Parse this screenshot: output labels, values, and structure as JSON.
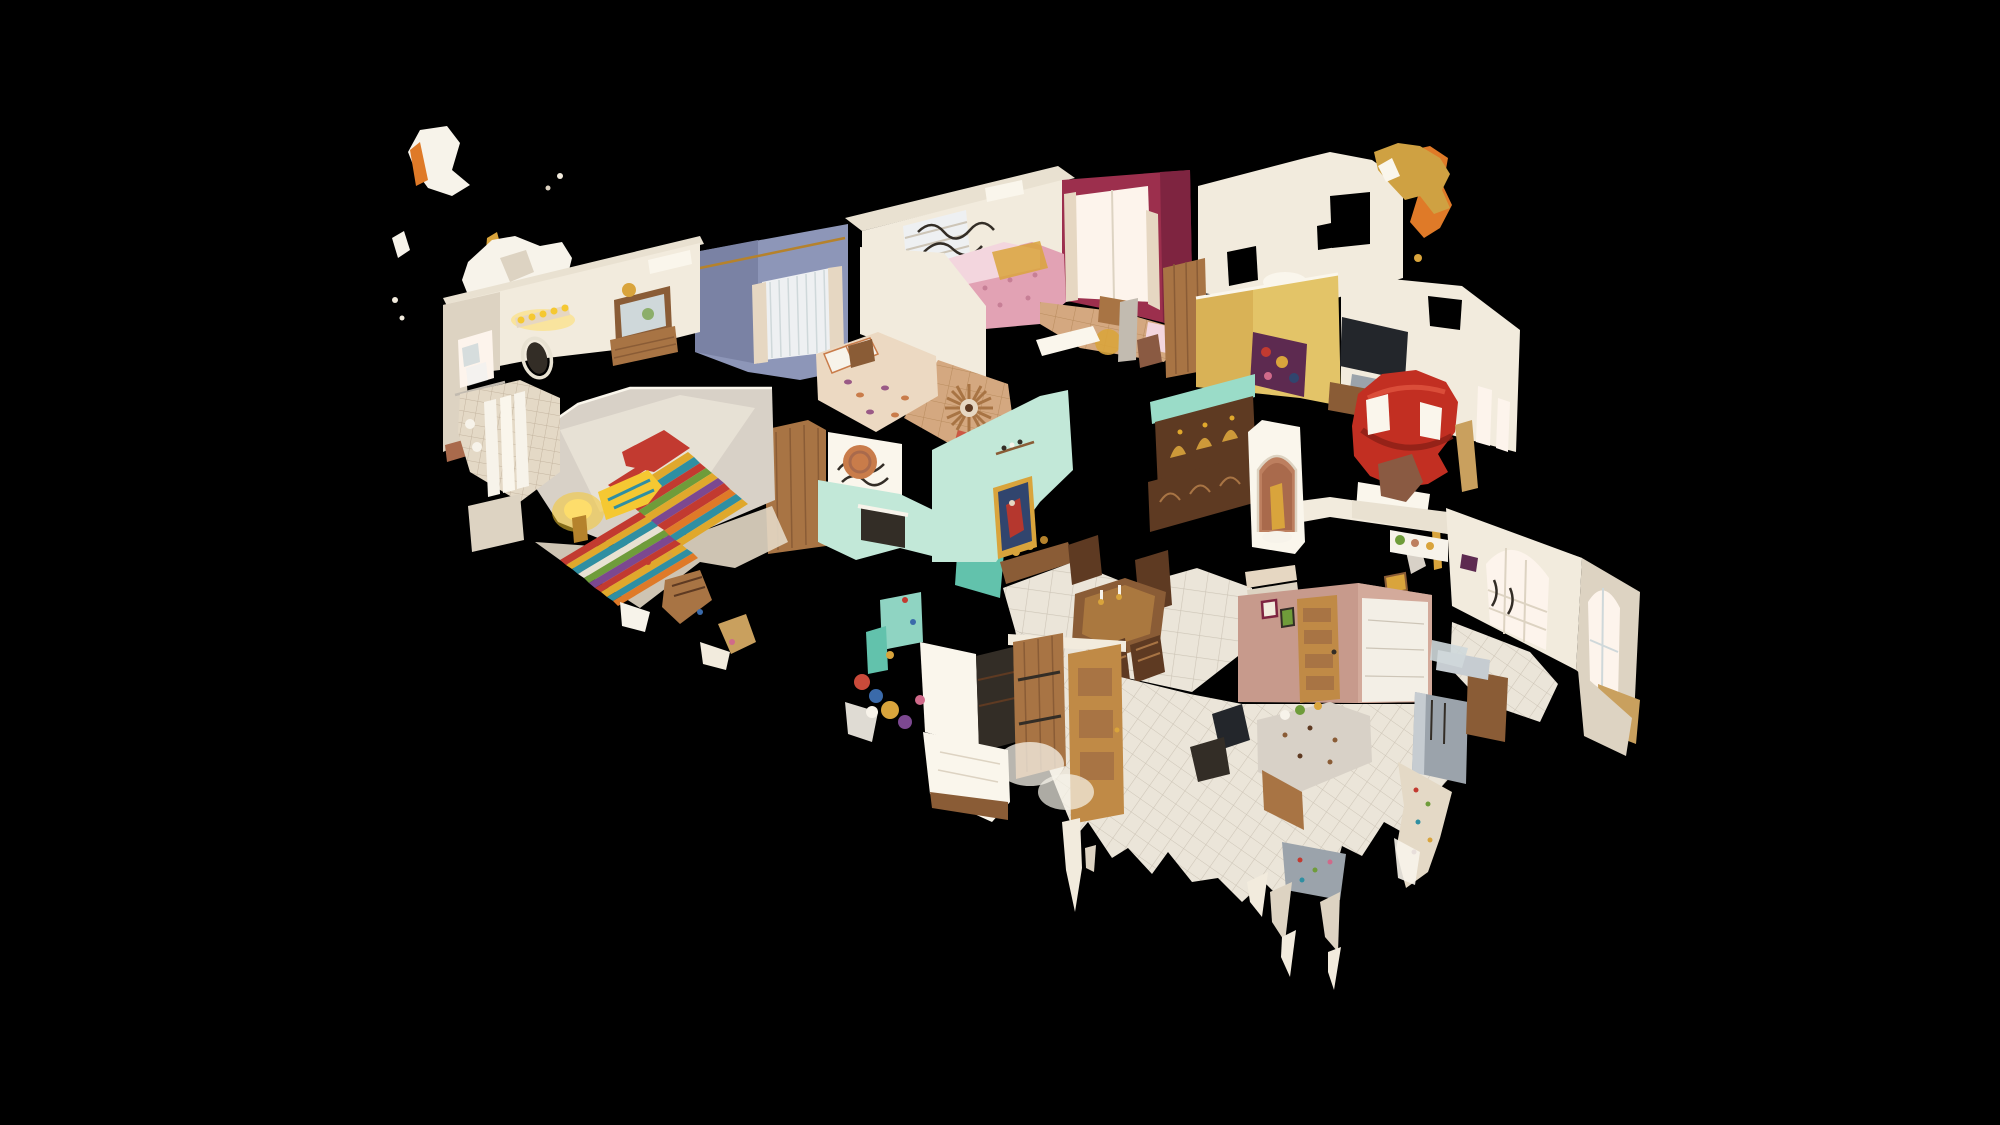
{
  "app": {
    "name": "3D dollhouse viewer",
    "view_mode": "dollhouse",
    "background": "#000000",
    "aria_label": "3D dollhouse cutaway scan of a single-story southwestern-style home viewed from above on a black background"
  },
  "scene": {
    "rooms": [
      {
        "id": "primary-bedroom",
        "accent": "serape-striped-beds"
      },
      {
        "id": "vanity-bathroom",
        "accent": "oval-mirror-and-lights"
      },
      {
        "id": "blue-bedroom",
        "accent": "periwinkle-wall"
      },
      {
        "id": "pink-bedroom",
        "accent": "floral-bed-magenta-wall"
      },
      {
        "id": "guest-bedroom",
        "accent": "paisley-bed-sunburst-mirror"
      },
      {
        "id": "dining-room",
        "accent": "turquoise-walls-carved-table"
      },
      {
        "id": "living-room",
        "accent": "yellow-walls-red-kiva-fireplace"
      },
      {
        "id": "hallway",
        "accent": "shrine-niche-saint-statue"
      },
      {
        "id": "kitchen",
        "accent": "salmon-walls-granite-island"
      },
      {
        "id": "breakfast-nook",
        "accent": "arched-windows"
      }
    ],
    "artifacts": [
      "floating-scan-fragments",
      "ragged-point-cloud-edges",
      "white-tile-floors"
    ]
  },
  "palette": {
    "bg": "#000000",
    "cream": "#f2ebdd",
    "creamBright": "#faf6ec",
    "creamShade": "#ddd3c2",
    "grayWall": "#d8d1c7",
    "grayWallDark": "#c2bbb0",
    "roof": "#e9e1d1",
    "blue": "#8d96b8",
    "blueDark": "#7a82a4",
    "blinds": "#eef0f2",
    "magenta": "#9c2f4d",
    "magentaDark": "#7e2440",
    "winBright": "#fdf4ec",
    "curtain": "#e6d7c2",
    "pinkBed": "#e2a2b4",
    "pinkLight": "#f3d6de",
    "pinkDot": "#c77f96",
    "paisley": "#ecd9c2",
    "paisleyOrange": "#c97c4a",
    "paisleyPlum": "#9a5a86",
    "yellow": "#e3c468",
    "yellowDeep": "#d4ab4e",
    "mustard": "#cfa142",
    "mint": "#c2e8d8",
    "mintDeep": "#9adcc8",
    "teal": "#8fd4c2",
    "tealDeep": "#62c2ac",
    "salmon": "#c79a8c",
    "salmonLight": "#d6ae9f",
    "terracotta": "#bd7f5f",
    "terracottaDeep": "#a96a4c",
    "kiva": "#c22f22",
    "kivaDark": "#8a1f16",
    "kivaLight": "#e05540",
    "woodDark": "#5e3a22",
    "wood": "#8a5c36",
    "woodOak": "#a87444",
    "woodGolden": "#c08a46",
    "woodLight": "#c9a05e",
    "saltillo": "#d4a880",
    "saltilloLine": "#b98c5e",
    "tile": "#ebe5d9",
    "tileBright": "#f3efe6",
    "grout": "#cdc5b7",
    "tileWarm": "#e4d9c6",
    "groutWarm": "#c4b5a0",
    "gold": "#d9a43c",
    "goldDeep": "#b5822c",
    "stainless": "#9ba3ab",
    "stainlessLight": "#c6ccd1",
    "tv": "#23262b",
    "leather": "#8a5a42",
    "lamp": "#f5c832",
    "lampGlow": "#ffdf6a",
    "stripeRed": "#c23a30",
    "stripeGold": "#e0a82c",
    "stripeTeal": "#2f8fa2",
    "stripeGreen": "#6f9c3a",
    "stripePurple": "#7c4890",
    "stripeOrange": "#df7a28",
    "stripeWhite": "#e8e2d2",
    "paintBlue": "#31456e",
    "paintRed": "#b5372e",
    "plum": "#5d2a50",
    "iron": "#332d26",
    "white": "#f7f3ea",
    "glass": "#cfd8da",
    "noiseBlue": "#3a6aaa",
    "noiseRed": "#c94a3a",
    "noisePink": "#d06a8a"
  }
}
